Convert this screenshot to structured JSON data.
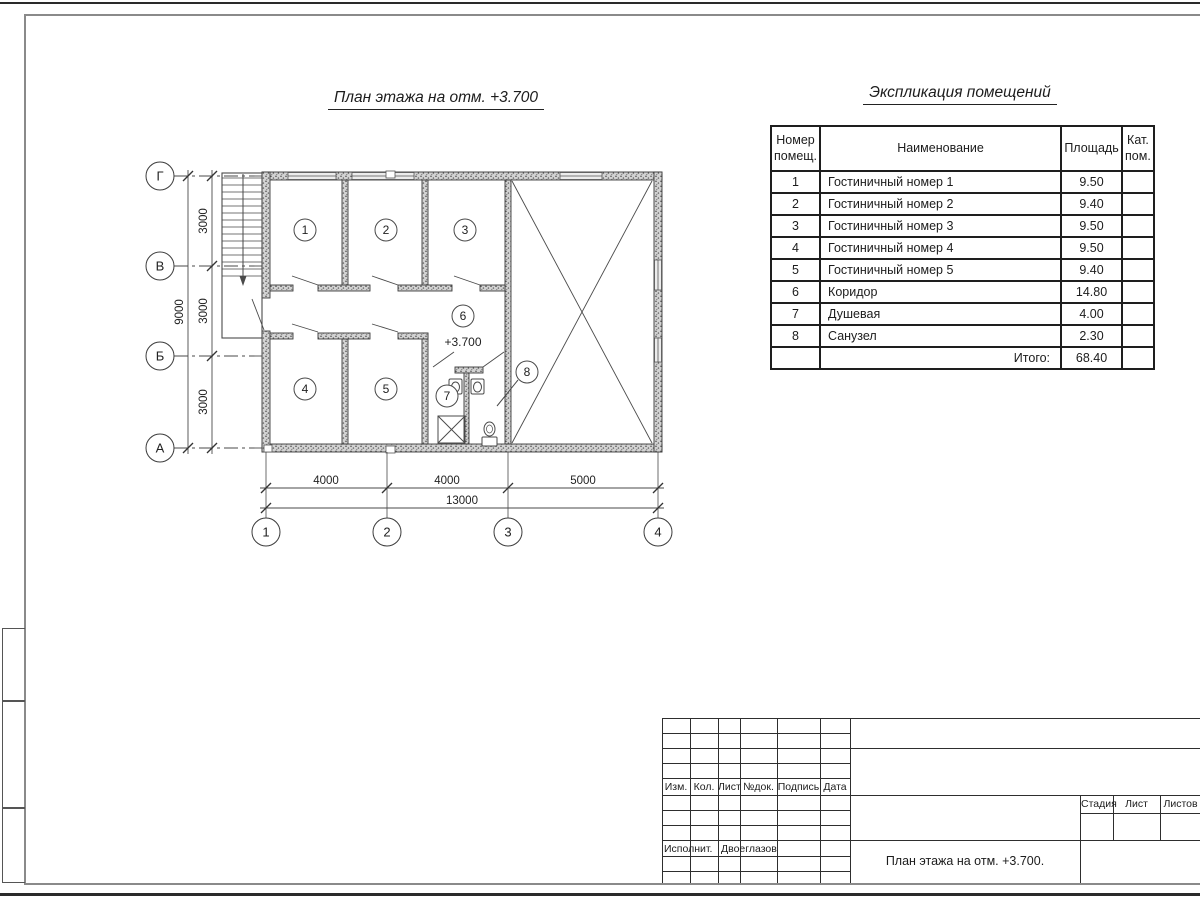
{
  "sheet": {
    "plan_title": "План этажа на отм. +3.700",
    "explication_title": "Экспликация помещений"
  },
  "colors": {
    "ink": "#2e2e2e",
    "wall_fill": "#d2d2d2"
  },
  "plan": {
    "row_axes": [
      "Г",
      "В",
      "Б",
      "А"
    ],
    "col_axes": [
      "1",
      "2",
      "3",
      "4"
    ],
    "dims_left": [
      "3000",
      "3000",
      "3000"
    ],
    "dim_left_total": "9000",
    "dims_bottom": [
      "4000",
      "4000",
      "5000"
    ],
    "dim_bottom_total": "13000",
    "rooms": [
      "1",
      "2",
      "3",
      "4",
      "5",
      "6",
      "7",
      "8"
    ],
    "elevation": "+3.700"
  },
  "explication": {
    "headers": {
      "number": "Номер помещ.",
      "name": "Наименование",
      "area": "Площадь",
      "category": "Кат. пом."
    },
    "rows": [
      {
        "number": "1",
        "name": "Гостиничный номер 1",
        "area": "9.50",
        "category": ""
      },
      {
        "number": "2",
        "name": "Гостиничный номер 2",
        "area": "9.40",
        "category": ""
      },
      {
        "number": "3",
        "name": "Гостиничный номер 3",
        "area": "9.50",
        "category": ""
      },
      {
        "number": "4",
        "name": "Гостиничный номер 4",
        "area": "9.50",
        "category": ""
      },
      {
        "number": "5",
        "name": "Гостиничный номер 5",
        "area": "9.40",
        "category": ""
      },
      {
        "number": "6",
        "name": "Коридор",
        "area": "14.80",
        "category": ""
      },
      {
        "number": "7",
        "name": "Душевая",
        "area": "4.00",
        "category": ""
      },
      {
        "number": "8",
        "name": "Санузел",
        "area": "2.30",
        "category": ""
      }
    ],
    "total_label": "Итого:",
    "total_area": "68.40"
  },
  "title_block": {
    "columns": [
      "Изм.",
      "Кол.",
      "Лист",
      "№док.",
      "Подпись",
      "Дата"
    ],
    "executor_label": "Исполнит.",
    "executor_name": "Двоеглазов",
    "stage_label": "Стадия",
    "sheet_label": "Лист",
    "sheets_label": "Листов",
    "document_title": "План этажа на отм. +3.700."
  }
}
